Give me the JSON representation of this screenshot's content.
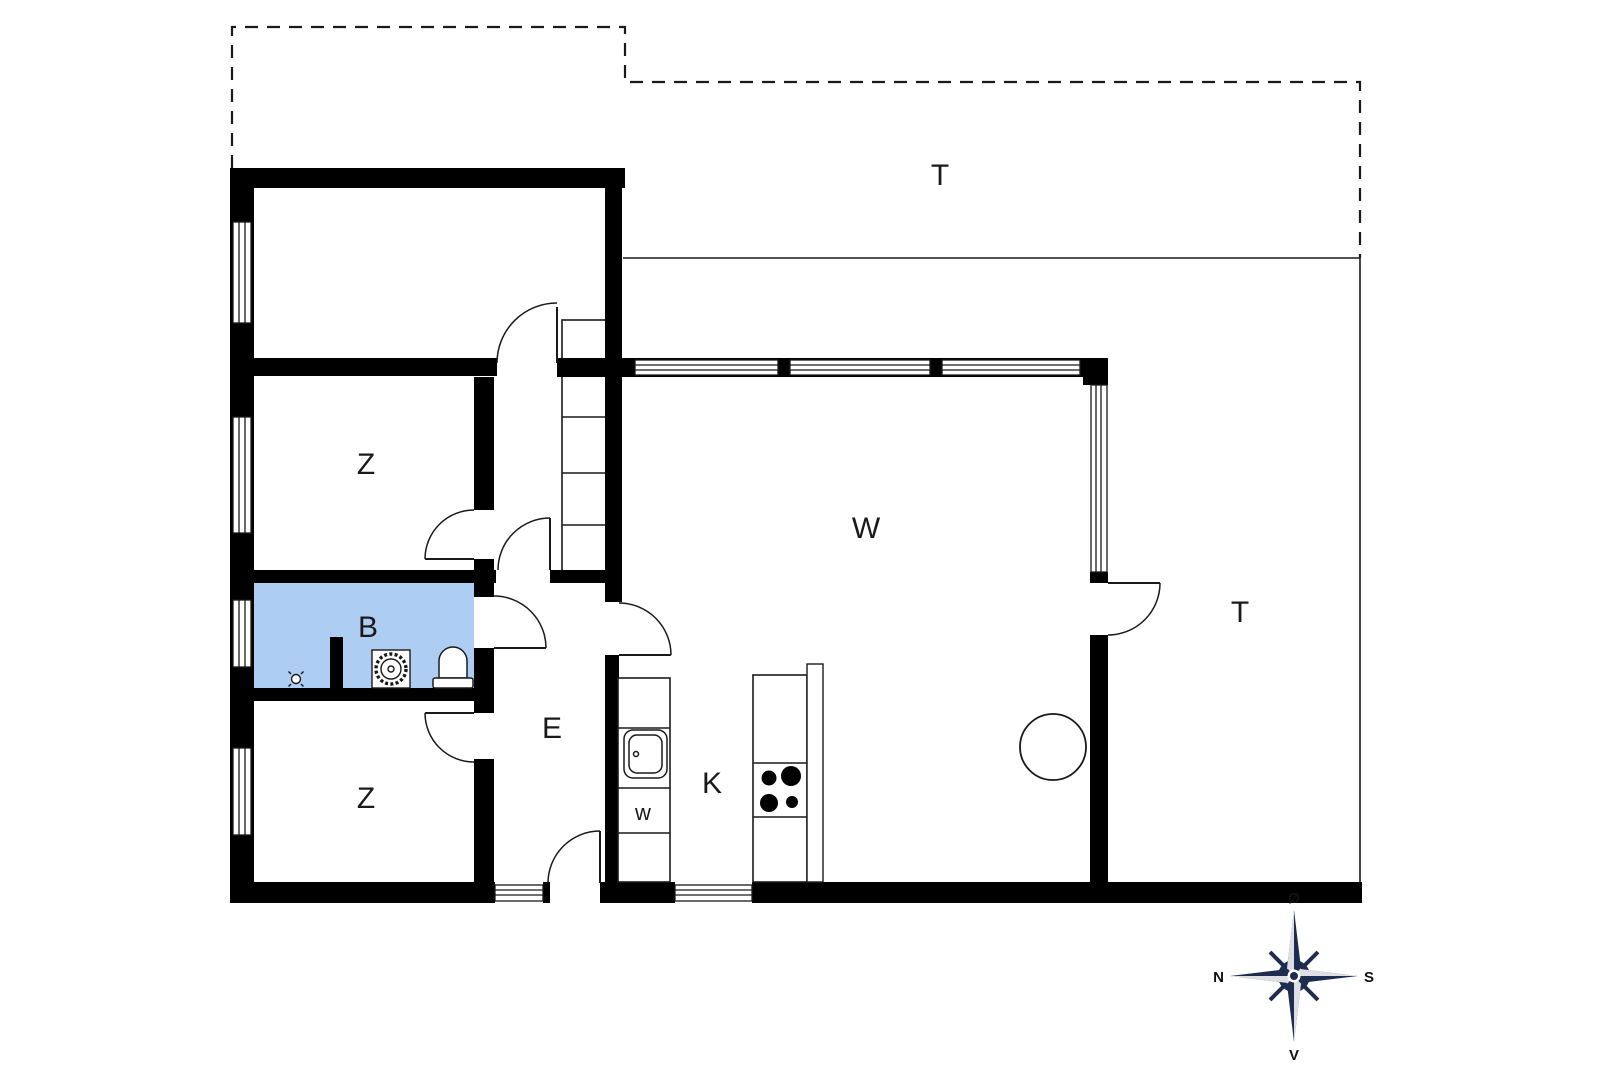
{
  "labels": {
    "terrace_top": "T",
    "terrace_right": "T",
    "living": "W",
    "kitchen": "K",
    "entry": "E",
    "bathroom": "B",
    "bedroom_upper": "Z",
    "bedroom_lower": "Z",
    "washer": "w"
  },
  "compass": {
    "top": "Ø",
    "right": "S",
    "bottom": "V",
    "left": "N"
  },
  "colors": {
    "background": "#ffffff",
    "wall": "#000000",
    "bathroom_floor": "#aecdf2",
    "compass": "#1e2c4f",
    "line": "#1a1a1a"
  },
  "icons": {
    "shower": "scalloped-circle-in-square",
    "toilet": "dome-with-tank",
    "sink": "rounded-basin-with-tap-dot",
    "stove": "four-burner-hob",
    "stairs": "tread-ladder",
    "table": "circle",
    "compass_rose": "eight-point-star"
  }
}
